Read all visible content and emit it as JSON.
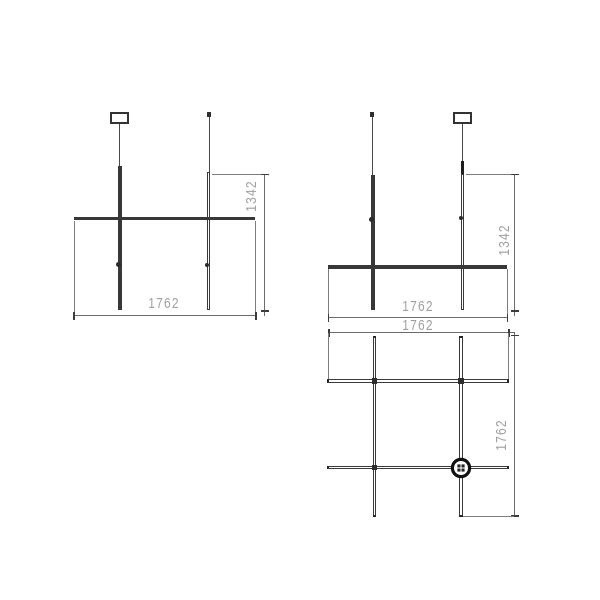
{
  "colors": {
    "background": "#ffffff",
    "drawing_line": "#383838",
    "dimension_line": "#6b6b6b",
    "dimension_text": "#a0a0a0"
  },
  "drawings": {
    "front_view": {
      "width_mm": "1762",
      "height_mm": "1342"
    },
    "side_view": {
      "width_mm": "1762",
      "height_mm": "1342"
    },
    "top_view": {
      "width_mm": "1762",
      "depth_mm": "1762"
    }
  },
  "icons": {
    "power_canopy": "circle with checker plug pattern at rod intersection",
    "ceiling_anchor": "small square ceiling fixing point"
  }
}
